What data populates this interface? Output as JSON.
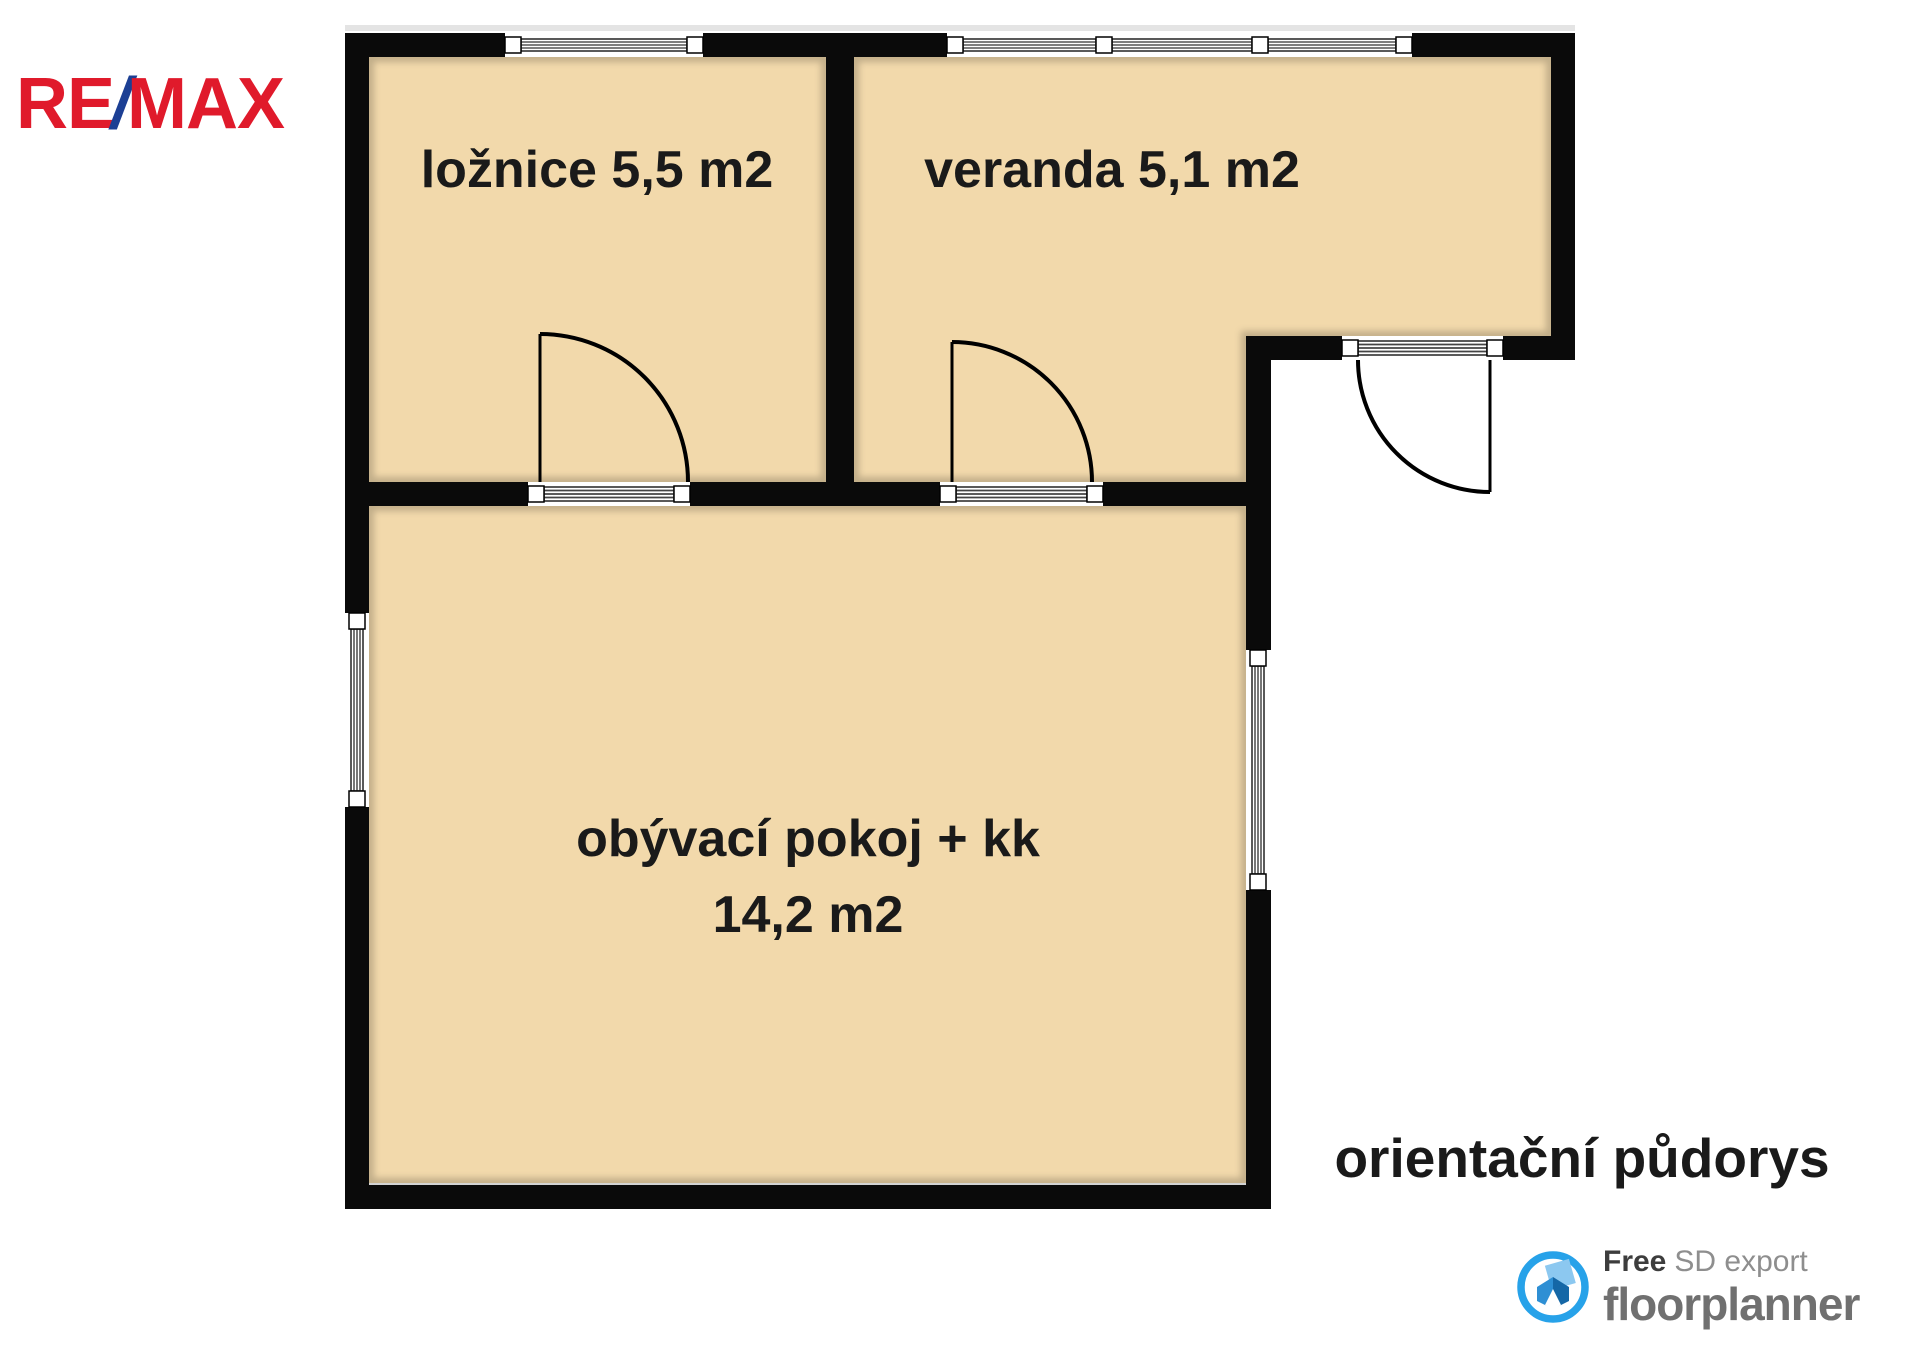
{
  "header": {
    "remax_logo": {
      "re": "RE",
      "slash": "/",
      "max": "MAX"
    }
  },
  "floorplan": {
    "rooms": [
      {
        "id": "loznice",
        "label": "ložnice 5,5 m2"
      },
      {
        "id": "veranda",
        "label": "veranda 5,1 m2"
      },
      {
        "id": "obyvaci-pokoj",
        "label": "obývací pokoj + kk",
        "area_label": "14,2 m2"
      }
    ],
    "caption": "orientační půdorys"
  },
  "footer": {
    "free_label": "Free",
    "sd_export_label": "SD export",
    "brand_name": "floorplanner"
  },
  "colors": {
    "remax_red": "#E01A2B",
    "remax_blue": "#1C3F94",
    "floor_fill": "#F2D9AB",
    "wall": "#0A0A0A",
    "floorplanner_blue": "#27A2E9",
    "label_text": "#1A1A1A"
  }
}
